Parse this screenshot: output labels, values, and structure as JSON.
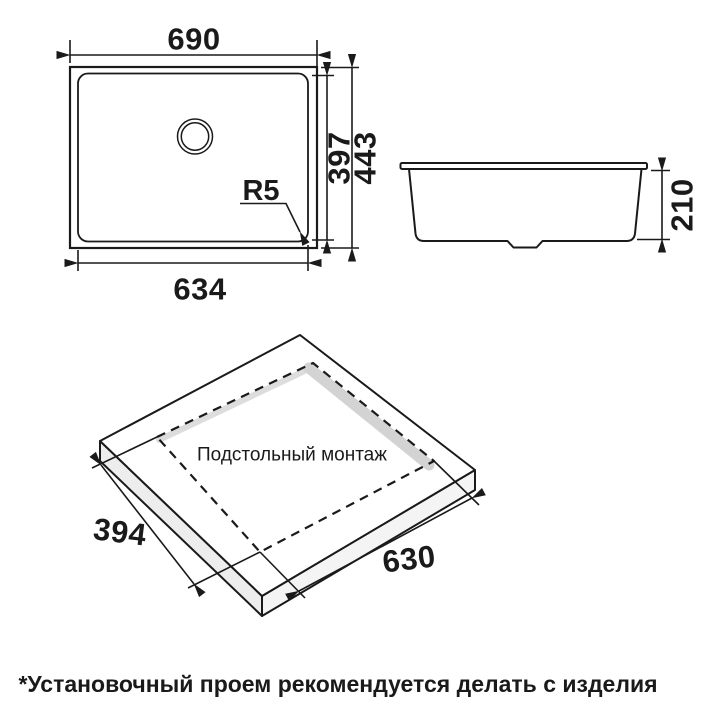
{
  "drawing": {
    "top_view": {
      "outer_width": "690",
      "inner_width": "634",
      "inner_height": "397",
      "outer_height": "443",
      "corner_radius_label": "R5"
    },
    "side_view": {
      "bowl_depth": "210"
    },
    "cutout_view": {
      "label": "Подстольный монтаж",
      "cutout_length": "630",
      "cutout_width": "394"
    },
    "footnote": "*Установочный проем рекомендуется делать с изделия"
  },
  "colors": {
    "line": "#1a1a1a",
    "background": "#ffffff",
    "slab_face_left": "#ededed",
    "slab_face_right": "#f4f4f4",
    "cutout_wall": "#d3d3d3",
    "cutout_wall_light": "#dddddd"
  }
}
